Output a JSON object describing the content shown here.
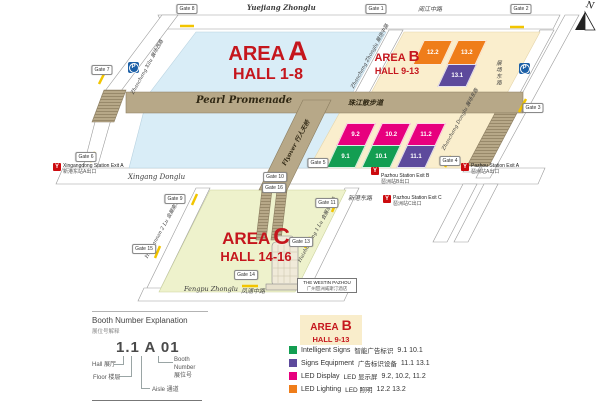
{
  "colors": {
    "area_red": "#c5161d",
    "area_a_fill": "#d9edf7",
    "area_b_fill": "#faeecd",
    "area_c_fill": "#eef2cc",
    "walkway_tan": "#b7a888",
    "intelligent_signs_green": "#139e52",
    "signs_equipment_purple": "#5d4a9c",
    "led_display_magenta": "#e7007e",
    "led_lighting_orange": "#ef7d1a",
    "metro_red": "#cc0a0e",
    "parking_blue": "#1b5fa6",
    "gate_crossing_yellow": "#f2c500"
  },
  "map": {
    "north_label": "N",
    "parking_label": "P",
    "metro_icon": "Y",
    "areas": {
      "a": {
        "word": "AREA",
        "letter": "A",
        "halls": "HALL 1-8"
      },
      "b": {
        "word": "AREA",
        "letter": "B",
        "halls": "HALL 9-13"
      },
      "c": {
        "word": "AREA",
        "letter": "C",
        "halls": "HALL 14-16"
      }
    },
    "roads": {
      "yuejiang_en": "Yuejiang Zhonglu",
      "yuejiang_cn": "阅江中路",
      "zhanchang_xilu": "Zhanchang Xilu 展场西路",
      "zhanchang_zhonglu": "Zhanchang Zhonglu 展场中路",
      "zhanchang_donglu": "Zhanchang Donglu 展场东路",
      "zhanchang_donglu_cn": "展场东路",
      "xingang_en": "Xingang Donglu",
      "xingang_cn": "新港东路",
      "huizhannan": "Huizhannan 2 Lu 会展南二路",
      "huizhandong": "Huizhandong 1 Lu 会展东一路",
      "fengpu_en": "Fengpu Zhonglu",
      "fengpu_cn": "凤浦中路"
    },
    "walkways": {
      "pearl_en": "Pearl Promenade",
      "pearl_cn": "珠江散步道",
      "flyover_en": "Flyover",
      "flyover_cn": "行人天桥"
    },
    "gates": [
      {
        "label": "Gate 1"
      },
      {
        "label": "Gate 2"
      },
      {
        "label": "Gate 3"
      },
      {
        "label": "Gate 4"
      },
      {
        "label": "Gate 5"
      },
      {
        "label": "Gate 6"
      },
      {
        "label": "Gate 7"
      },
      {
        "label": "Gate 8"
      },
      {
        "label": "Gate 9"
      },
      {
        "label": "Gate 10"
      },
      {
        "label": "Gate 11"
      },
      {
        "label": "Gate 13"
      },
      {
        "label": "Gate 14"
      },
      {
        "label": "Gate 15"
      },
      {
        "label": "Gate 16"
      }
    ],
    "stations": [
      {
        "name": "Xingangdong Station Exit A",
        "cn": "新港东站A出口"
      },
      {
        "name": "Pazhou Station Exit B",
        "cn": "琶洲站B出口"
      },
      {
        "name": "Pazhou Station Exit A",
        "cn": "琶洲站A出口"
      },
      {
        "name": "Pazhou Station Exit C",
        "cn": "琶洲站C出口"
      }
    ],
    "halls": [
      {
        "label": "12.2",
        "category": "LED Lighting"
      },
      {
        "label": "13.2",
        "category": "LED Lighting"
      },
      {
        "label": "13.1",
        "category": "Signs Equipment"
      },
      {
        "label": "9.2",
        "category": "LED Display"
      },
      {
        "label": "10.2",
        "category": "LED Display"
      },
      {
        "label": "11.2",
        "category": "LED Display"
      },
      {
        "label": "9.1",
        "category": "Intelligent Signs"
      },
      {
        "label": "10.1",
        "category": "Intelligent Signs"
      },
      {
        "label": "11.1",
        "category": "Signs Equipment"
      }
    ],
    "hotel": {
      "line1": "THE WESTIN PAZHOU",
      "line2": "广州琶洲威斯汀酒店"
    }
  },
  "booth_legend": {
    "title": "Booth Number Explanation",
    "title_cn": "展位号解释",
    "example": "1.1 A 01",
    "hall": "Hall 展厅",
    "floor": "Floor 楼层",
    "aisle": "Aisle 通道",
    "booth": "Booth\nNumber\n展位号"
  },
  "area_legend": {
    "word": "AREA",
    "letter": "B",
    "halls": "HALL 9-13",
    "items": [
      {
        "name_en": "Intelligent Signs",
        "name_cn": "智能广告标识",
        "halls": "9.1 10.1",
        "color": "#139e52"
      },
      {
        "name_en": "Signs Equipment",
        "name_cn": "广告标识设备",
        "halls": "11.1  13.1",
        "color": "#5d4a9c"
      },
      {
        "name_en": "LED Display",
        "name_cn": "LED 显示屏",
        "halls": "9.2, 10.2, 11.2",
        "color": "#e7007e"
      },
      {
        "name_en": "LED Lighting",
        "name_cn": "LED 照明",
        "halls": "12.2  13.2",
        "color": "#ef7d1a"
      }
    ]
  }
}
